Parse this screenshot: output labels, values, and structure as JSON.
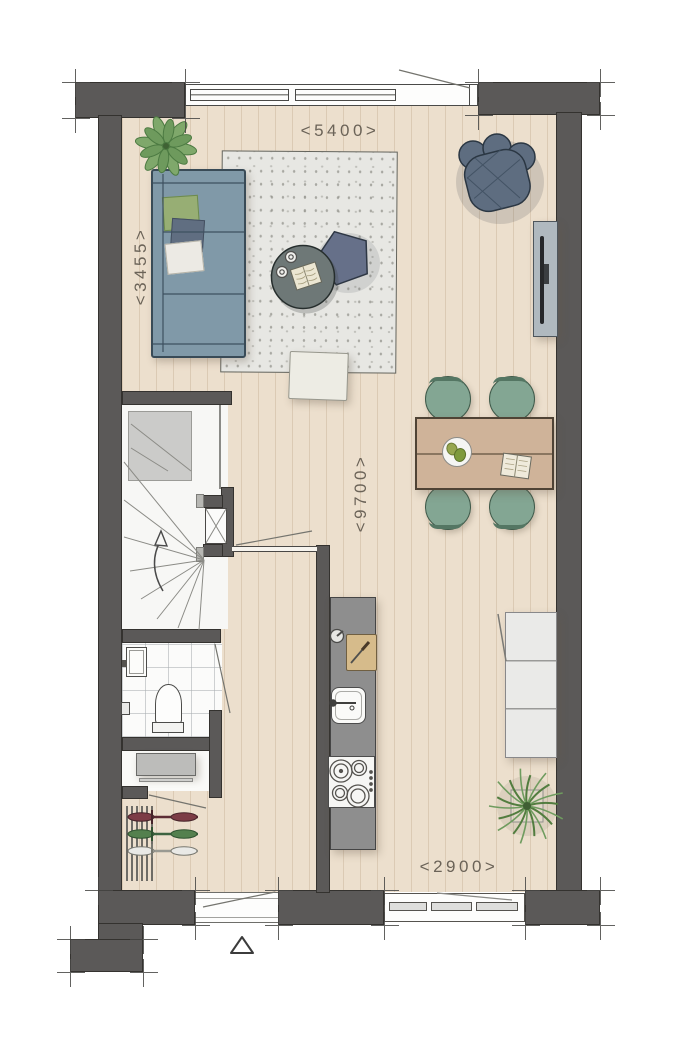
{
  "plan": {
    "dimension_labels": {
      "top": "<5400>",
      "left": "<3455>",
      "center": "<9700>",
      "bottom": "<2900>"
    },
    "colors": {
      "wall": "#5b5958",
      "floor": "#ecdfcd",
      "rug": "#e7e7e3",
      "sofa": "#8099a8",
      "armchair": "#5e6d80",
      "dining_chair": "#83a693",
      "table_wood": "#cfb399",
      "kitchen_counter": "#8e8e8e",
      "sideboard": "#eaeae8",
      "plant_green": "#6f9c5f",
      "pillow_green": "#97ae74",
      "dimension_text": "#6b6358"
    },
    "icons": [
      "sofa",
      "rug",
      "coffee-table",
      "pentagon-side-table",
      "pouf",
      "armchair",
      "tv-cabinet",
      "dining-table",
      "dining-chair",
      "plate",
      "open-book",
      "kitchen-counter",
      "cutting-board",
      "kitchen-sink",
      "cooktop",
      "stairs",
      "stair-direction-arrow",
      "toilet",
      "wash-basin",
      "toilet-paper-holder",
      "meter-cabinet",
      "bike-rack",
      "bike",
      "sideboard",
      "potted-plant",
      "palm-plant",
      "window",
      "door-swing",
      "entrance-marker-triangle"
    ]
  }
}
